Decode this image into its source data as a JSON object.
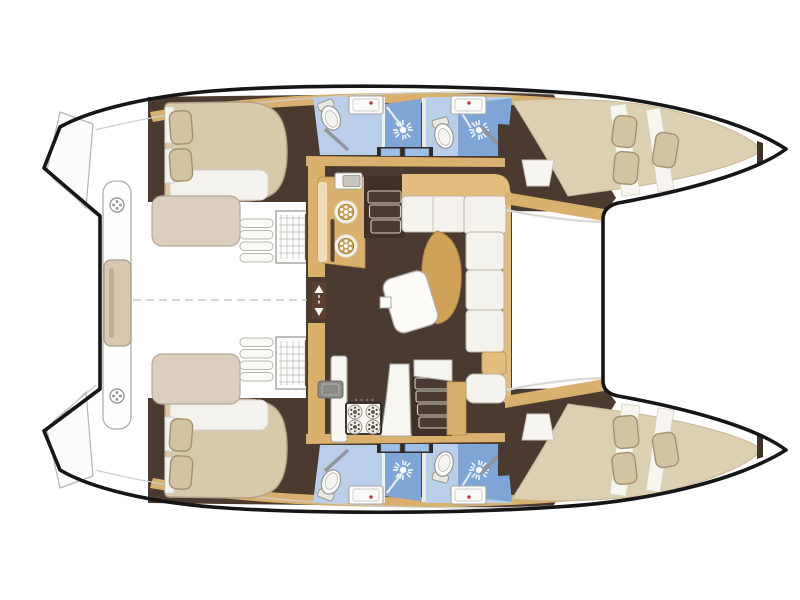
{
  "diagram": {
    "type": "boat-floor-plan",
    "subject": "catamaran sailing yacht accommodation layout, top-down view",
    "orientation": {
      "bow": "right",
      "stern": "left",
      "centerline": "horizontal dashed line in cockpit"
    },
    "symmetry": "port and starboard hulls are mirrored",
    "cabin_count": 4,
    "head_count": 4,
    "shower_count": 4
  },
  "rooms": {
    "port_hull": {
      "label": "Port hull (top): aft double cabin, aft head with shower, forward head with shower, forward double cabin",
      "aft_cabin": {
        "label": "Port aft cabin with double berth, pillows, bench seat and storage"
      },
      "aft_head": {
        "label": "Port aft bathroom: toilet, washbasin, separate shower"
      },
      "forward_head": {
        "label": "Port forward bathroom: toilet, washbasin, separate shower"
      },
      "forward_cabin": {
        "label": "Port forward cabin with tapered double berth in bow"
      }
    },
    "starboard_hull": {
      "label": "Starboard hull (bottom): mirror of port hull with two cabins and two heads"
    },
    "saloon": {
      "label": "Bridgedeck saloon with galley, L-shaped dinette sofa, tables and two companionways",
      "galley_aft": {
        "label": "Galley block with twin round hobs, oven and handrail"
      },
      "galley_counter": {
        "label": "Galley counter with sink and 4-burner stove"
      },
      "dinette": {
        "label": "L-shaped dinette sofa with cushions and forward-facing bench"
      },
      "tables": {
        "label": "Curved wooden saloon table and tilted white table"
      },
      "companionways": {
        "label": "Steps down into each hull"
      },
      "aft_door": {
        "label": "Aft sliding-door passage marked with up/down arrows"
      }
    },
    "cockpit": {
      "label": "Aft cockpit (white area) with transom platform, bench and deck hatches"
    },
    "foredeck": {
      "label": "Foredeck between coachroof and forward beam"
    },
    "trampoline": {
      "label": "Open trampoline area between the bows (right)"
    }
  },
  "icons": [
    "shower-rose-icon",
    "toilet-icon",
    "washbasin-icon",
    "stove-burner-icon",
    "round-hob-icon",
    "deck-hatch-icon",
    "companionway-arrows-icon",
    "stair-treads-icon",
    "storage-grate-icon"
  ],
  "colors": {
    "outline": "#161616",
    "floor_dark": "#4a3a30",
    "door_dark": "#352a22",
    "wood": "#d9b06e",
    "wood_light": "#e2bd7e",
    "mattress": "#d8c9ab",
    "mattress_edge": "#b3a284",
    "berth": "#ddcfb2",
    "pillow": "#d4c3a3",
    "pillow_edge": "#a3916f",
    "cushion": "#f4f2ec",
    "seat_beige": "#dbcebd",
    "bath_blue": "#b9cfe9",
    "shower_blue": "#7fa5d6",
    "window_blue": "#9fc0e6",
    "bench_tan": "#d8c8b2",
    "background": "#ffffff"
  }
}
